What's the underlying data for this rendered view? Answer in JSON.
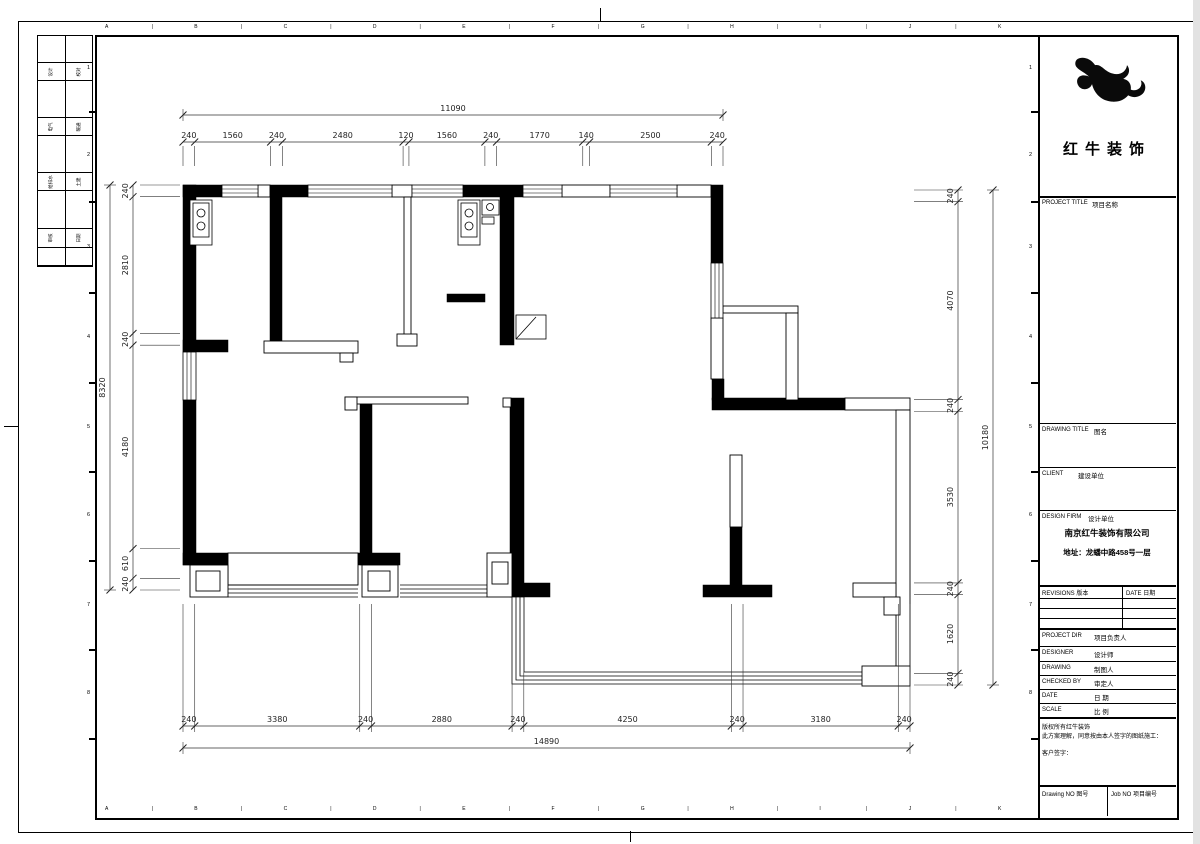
{
  "sheet": {
    "grid_letters": [
      "A",
      "B",
      "C",
      "D",
      "E",
      "F",
      "G",
      "H",
      "I",
      "J",
      "K"
    ],
    "grid_letter_separator": "|",
    "grid_row_numbers": [
      "1",
      "2",
      "3",
      "4",
      "5",
      "6",
      "7",
      "8"
    ],
    "signature_strip": [
      {
        "left": "设计",
        "right": "校对"
      },
      {
        "left": "电气",
        "right": "暖通"
      },
      {
        "left": "给排水",
        "right": "土建"
      },
      {
        "left": "审核",
        "right": "日期"
      }
    ]
  },
  "title_block": {
    "logo_text": "红牛装饰",
    "project_title_label": "PROJECT TITLE",
    "project_title_cn": "项目名称",
    "drawing_title_label": "DRAWING TITLE",
    "drawing_title_cn": "图名",
    "client_label": "CLIENT",
    "client_cn": "建设单位",
    "design_firm_label": "DESIGN FIRM",
    "design_firm_cn": "设计单位",
    "firm_name": "南京红牛装饰有限公司",
    "firm_address": "地址：龙蟠中路458号一层",
    "revisions_label": "REVISIONS 版本",
    "revisions_date_label": "DATE 日期",
    "project_dir_label": "PROJECT DIR",
    "project_dir_cn": "项目负责人",
    "designer_label": "DESIGNER",
    "designer_cn": "设计师",
    "drawing_label": "DRAWING",
    "drawing_cn": "制图人",
    "checked_by_label": "CHECKED BY",
    "checked_by_cn": "审定人",
    "date_row_label": "DATE",
    "date_row_cn": "日 期",
    "scale_label": "SCALE",
    "scale_cn": "比 例",
    "copyright_line1": "版权所有红牛装饰",
    "copyright_line2": "此方案理解，同意按由本人签字的图纸施工：",
    "client_sign_label": "客户签字：",
    "drawing_no_label": "Drawing NO 图号",
    "job_no_label": "Job NO 项目编号"
  },
  "dims": {
    "top": {
      "overall": "11090",
      "segments": [
        "240",
        "1560",
        "240",
        "2480",
        "120",
        "1560",
        "240",
        "1770",
        "140",
        "2500",
        "240"
      ]
    },
    "bottom": {
      "overall": "14890",
      "segments": [
        "240",
        "3380",
        "240",
        "2880",
        "240",
        "4250",
        "240",
        "3180",
        "240"
      ]
    },
    "left": {
      "overall": "8320",
      "segments": [
        "240",
        "2810",
        "240",
        "4180",
        "610",
        "240"
      ]
    },
    "right": {
      "overall": "10180",
      "segments": [
        "240",
        "4070",
        "240",
        "3530",
        "240",
        "1620",
        "240"
      ]
    }
  }
}
